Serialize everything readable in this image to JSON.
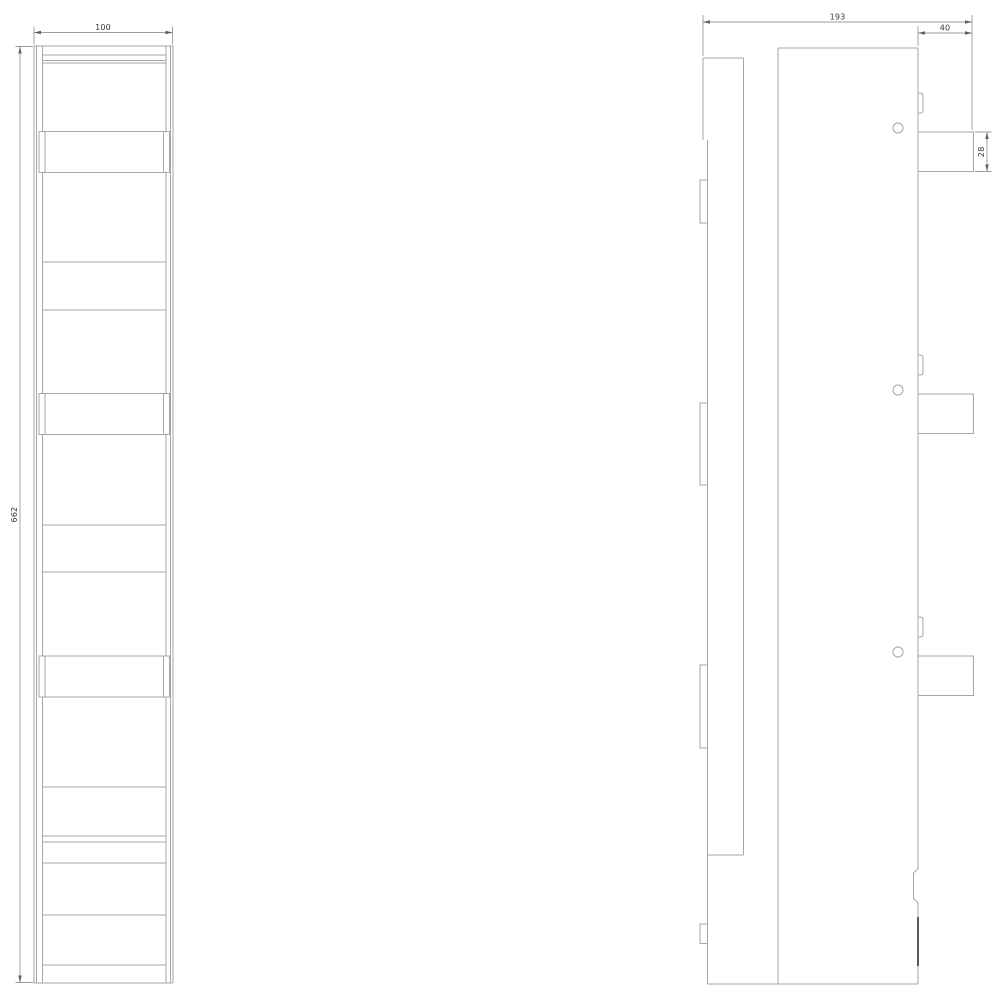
{
  "drawing": {
    "type": "cad-technical-drawing",
    "background_color": "#ffffff",
    "line_color": "#a6a6a6",
    "thick_line_color": "#5c5c5c",
    "dimension_line_color": "#9b9b9b",
    "dimension_text_color": "#353535",
    "views": {
      "front": {
        "cover_band_count": 3,
        "section_divider_count": 10
      },
      "side": {
        "terminal_tab_count": 3,
        "mounting_hole_count": 3,
        "clip_tab_count": 3
      }
    },
    "dimensions": {
      "front_width": "100",
      "front_height": "662",
      "side_width": "193",
      "terminal_width": "40",
      "terminal_height": "28"
    }
  }
}
